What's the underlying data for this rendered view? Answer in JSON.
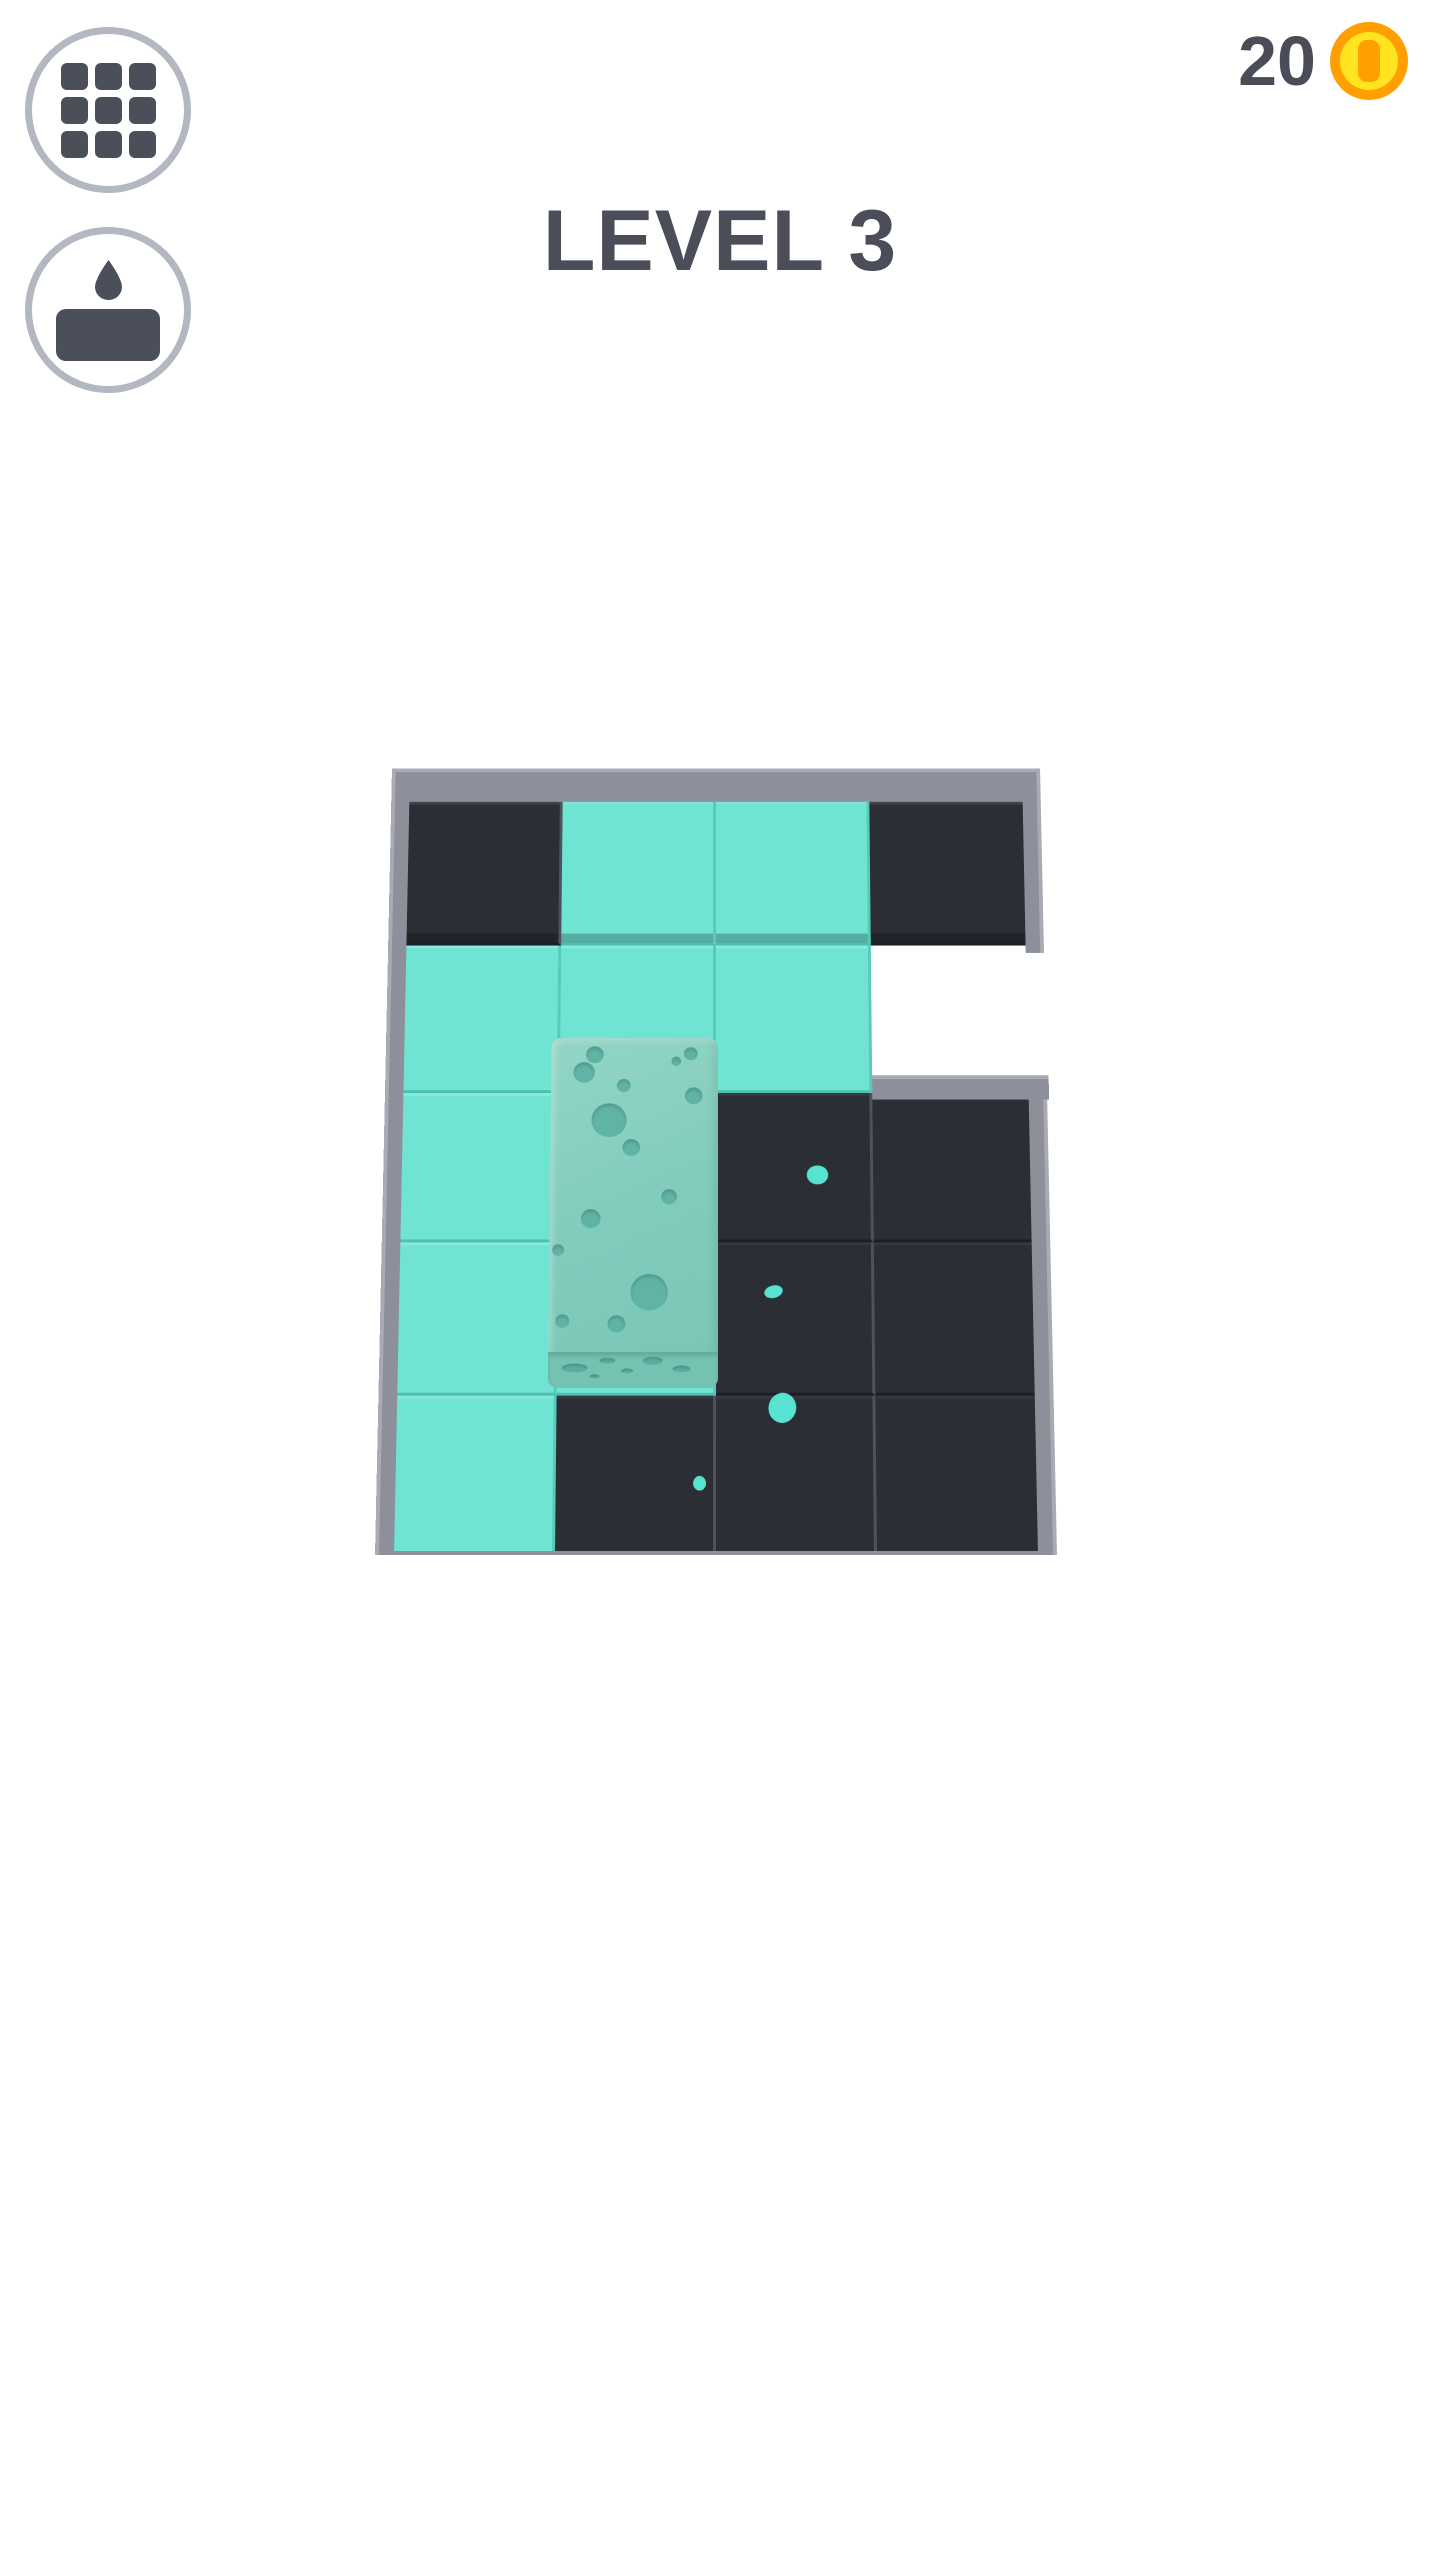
{
  "header": {
    "level_title": "LEVEL 3"
  },
  "hud": {
    "coin_count": "20"
  },
  "palette": {
    "ink": "#4b4e59",
    "tile-teal": "#6fe4d3",
    "tile-dark": "#2b2e35",
    "wall": "#8d8f9a",
    "sponge": "#7fcbbc",
    "splat": "#58e2d1",
    "coin-orange": "#ffa000",
    "coin-yellow": "#ffe41f",
    "button-ring": "#b3b7c1"
  },
  "board": {
    "rows": 5,
    "cols": 4,
    "grid": [
      [
        "dark",
        "teal",
        "teal",
        "dark"
      ],
      [
        "teal",
        "teal",
        "teal",
        "hole"
      ],
      [
        "teal",
        "teal",
        "dark",
        "dark"
      ],
      [
        "teal",
        "teal",
        "dark",
        "dark"
      ],
      [
        "teal",
        "dark",
        "dark",
        "dark"
      ]
    ],
    "sponge": {
      "holes": [
        {
          "x": 45,
          "y": 18,
          "r": 9
        },
        {
          "x": 34,
          "y": 37,
          "r": 11
        },
        {
          "x": 129,
          "y": 25,
          "r": 5
        },
        {
          "x": 144,
          "y": 17,
          "r": 7
        },
        {
          "x": 75,
          "y": 51,
          "r": 7
        },
        {
          "x": 147,
          "y": 62,
          "r": 9
        },
        {
          "x": 60,
          "y": 88,
          "r": 18
        },
        {
          "x": 83,
          "y": 117,
          "r": 9
        },
        {
          "x": 122,
          "y": 169,
          "r": 8
        },
        {
          "x": 42,
          "y": 192,
          "r": 10
        },
        {
          "x": 9,
          "y": 225,
          "r": 6
        },
        {
          "x": 102,
          "y": 269,
          "r": 19
        },
        {
          "x": 69,
          "y": 302,
          "r": 9
        },
        {
          "x": 14,
          "y": 299,
          "r": 7
        }
      ],
      "face_holes": [
        {
          "x": 14,
          "y": 12,
          "w": 26,
          "h": 9
        },
        {
          "x": 52,
          "y": 6,
          "w": 16,
          "h": 6
        },
        {
          "x": 74,
          "y": 17,
          "w": 12,
          "h": 5
        },
        {
          "x": 96,
          "y": 5,
          "w": 20,
          "h": 8
        },
        {
          "x": 126,
          "y": 14,
          "w": 18,
          "h": 7
        },
        {
          "x": 42,
          "y": 23,
          "w": 10,
          "h": 4
        }
      ]
    },
    "splats": [
      {
        "x": 442,
        "y": 438,
        "w": 22,
        "h": 20,
        "rot": 0
      },
      {
        "x": 396,
        "y": 560,
        "w": 19,
        "h": 13,
        "rot": -15
      },
      {
        "x": 405,
        "y": 680,
        "w": 28,
        "h": 31,
        "rot": 8
      },
      {
        "x": 321,
        "y": 757,
        "w": 13,
        "h": 15,
        "rot": 0
      }
    ]
  }
}
